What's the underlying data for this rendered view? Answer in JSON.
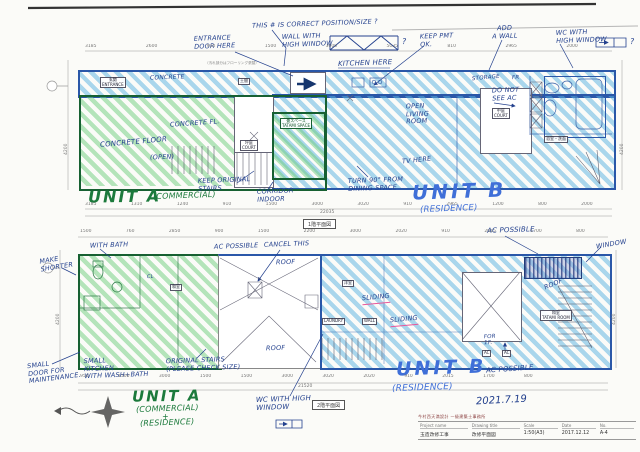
{
  "colors": {
    "unit_a_green": "#1c7a3c",
    "unit_b_blue": "#3f6fd8",
    "hatch_green": "#6ecd7d",
    "hatch_blue": "#58b2e0",
    "ink_blue": "#24418e",
    "pink_underline": "#e8589a"
  },
  "plan1": {
    "sheet_tag": "1階平面図",
    "unit_a": "UNIT A",
    "unit_a_sub": "(COMMERCIAL)",
    "unit_b": "UNIT B",
    "unit_b_sub": "(RESIDENCE)",
    "notes": {
      "this_correct": "THIS # IS CORRECT POSITION/SIZE ?",
      "wall_high_window": "WALL WITH\nHIGH WINDOW",
      "truss_q": "?",
      "entrance_door": "ENTRANCE\nDOOR HERE",
      "kitchen_here": "KITCHEN HERE",
      "keep_pmt": "KEEP PMT\nOK.",
      "add_wall": "ADD\nA WALL",
      "wc_high_window": "WC WITH\nHIGH WINDOW",
      "wc_q": "?",
      "flooring_note": "（汚れ部分はフローリング張替）",
      "concrete_strip": "CONCRETE",
      "storage": "STORAGE",
      "fr": "FR",
      "do_not_see_ac": "DO NOT\nSEE AC",
      "open_living": "OPEN\nLIVING\nROOM",
      "tv_here": "TV HERE",
      "concrete_floor": "CONCRETE FLOOR",
      "open_paren": "(OPEN)",
      "concrete_fl": "CONCRETE FL.",
      "keep_stairs": "KEEP ORIGINAL\nSTAIRS",
      "corridor_indoor": "CORRIDOR\nINDOOR",
      "turn_dining": "TURN 90° FROM\nDINING SPACE"
    },
    "rooms": {
      "entrance": "玄関\nENTRANCE",
      "doma": "土間",
      "court1": "坪庭\nCOURT",
      "court2": "中庭\nCOURT",
      "tatami_space": "畳スペース\nTATAMI SPACE",
      "bath": "浴室・洗面"
    },
    "dims": {
      "top": [
        "3185",
        "2600",
        "910",
        "1500",
        "3000",
        "5035",
        "810",
        "2965",
        "2000"
      ],
      "bottom": [
        "3185",
        "1310",
        "1240",
        "910",
        "1500",
        "3000",
        "3020",
        "910",
        "2965",
        "1200",
        "800",
        "2000"
      ],
      "total": "22035",
      "left": "4200",
      "right": "4200"
    }
  },
  "plan2": {
    "sheet_tag": "2階平面図",
    "unit_a": "UNIT A",
    "unit_a_sub1": "(COMMERCIAL)",
    "unit_a_plus": "+",
    "unit_a_sub2": "(RESIDENCE)",
    "unit_b": "UNIT B",
    "unit_b_sub": "(RESIDENCE)",
    "date_note": "2021.7.19",
    "notes": {
      "with_bath": "WITH BATH",
      "make_shorter": "MAKE\nSHORTER",
      "ac_possible_left": "AC POSSIBLE",
      "cancel_this": "CANCEL THIS",
      "roof_mid": "ROOF",
      "roof_low": "ROOF",
      "roof_right": "ROOF",
      "ac_possible_top": "AC POSSIBLE",
      "window_note": "WINDOW",
      "cl": "CL",
      "sliding1": "SLIDING",
      "sliding2": "SLIDING",
      "laundry": "LAUNDRY",
      "wall": "WALL",
      "for_1f": "FOR\n1F.",
      "ac1": "AC",
      "ac2": "AC",
      "small_door": "SMALL\nDOOR FOR\nMAINTENANCE.",
      "small_kitchen": "SMALL\nKITCHEN\nWITH WASH+BATH",
      "original_stairs": "ORIGINAL STAIRS\n(PLEASE CHECK SIZE)",
      "wc_high_window": "WC WITH HIGH\nWINDOW",
      "ac_possible_bottom": "AC POSSIBLE"
    },
    "rooms": {
      "bedroom": "洋室",
      "washitsu": "和室",
      "tatami_room": "和室\nTATAMI ROOM"
    },
    "dims": {
      "top": [
        "1500",
        "760",
        "2850",
        "900",
        "1500",
        "2200",
        "3000",
        "2020",
        "910",
        "2015",
        "1700",
        "800"
      ],
      "bottom": [
        "950",
        "1500",
        "3000",
        "1500",
        "1500",
        "3000",
        "3020",
        "2020",
        "910",
        "2015",
        "1700",
        "800"
      ],
      "total": "21520",
      "left": "4200",
      "right": "4200"
    }
  },
  "title_block": {
    "firm_line": "今村西天満設計  一級建築士事務所",
    "headers": {
      "project": "Project name",
      "drawing": "Drawing title",
      "scale": "Scale",
      "date": "Date",
      "no": "No."
    },
    "values": {
      "project": "玉造改修工事",
      "drawing": "改修平面図",
      "scale": "1:50(A3)",
      "date": "2017.12.12",
      "no": "A-4"
    }
  }
}
